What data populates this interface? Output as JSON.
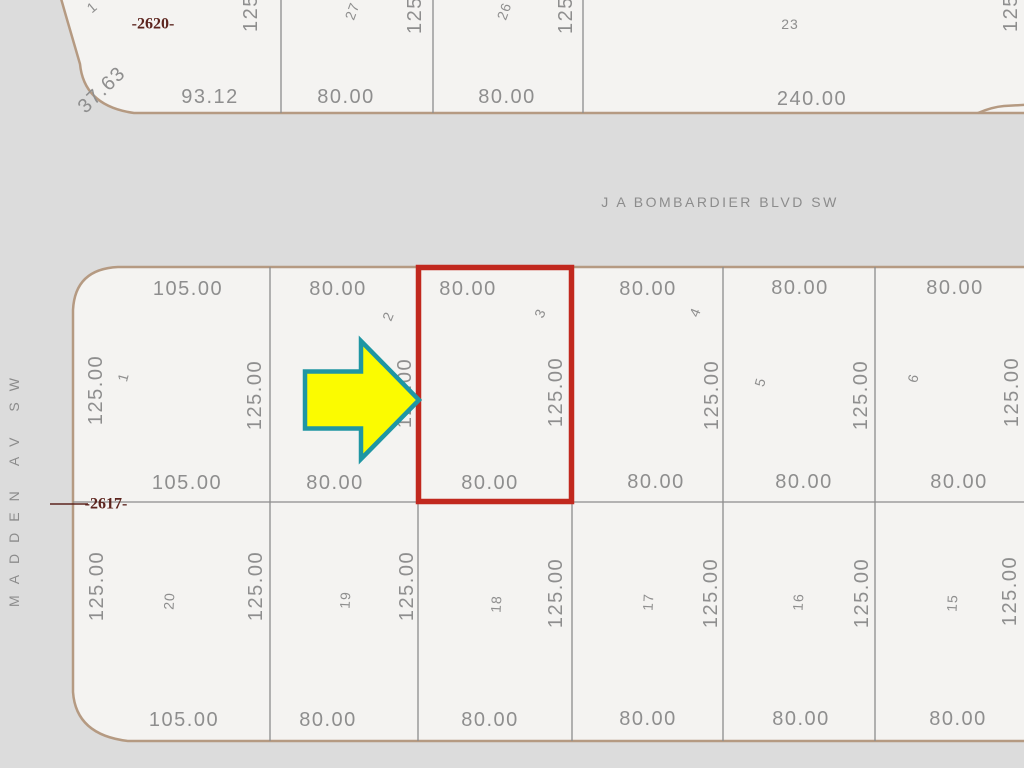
{
  "colors": {
    "street_bg": "#dcdcdc",
    "lot_fill": "#f4f3f1",
    "block_outline": "#b59a82",
    "lot_line": "#8c8c8c",
    "label_text": "#8e8e8e",
    "block_number_text": "#5c241e",
    "highlight_red": "#c1281e",
    "arrow_fill": "#fbfb00",
    "arrow_outline": "#1f96a3"
  },
  "streets": {
    "bombardier": "J A BOMBARDIER BLVD SW",
    "madden": "MADDEN AV SW"
  },
  "upper_block": {
    "number": "-2620-",
    "corner_lot": "1",
    "corner_dim": "37.63",
    "bottom_dims": [
      "93.12",
      "80.00",
      "80.00",
      "240.00"
    ],
    "lot_numbers": [
      "27",
      "26",
      "23"
    ],
    "side_dims_cut": [
      "125",
      "125",
      "125",
      "125"
    ]
  },
  "main_block": {
    "number": "-2617-",
    "north_row": {
      "lot_numbers": [
        "1",
        "2",
        "3",
        "4",
        "5",
        "6"
      ],
      "front_dims": [
        "105.00",
        "80.00",
        "80.00",
        "80.00",
        "80.00",
        "80.00"
      ],
      "rear_dims": [
        "105.00",
        "80.00",
        "80.00",
        "80.00",
        "80.00",
        "80.00"
      ],
      "side_dims": [
        "125.00",
        "125.00",
        "125.00",
        "125.00",
        "125.00",
        "125.00",
        "125.00"
      ]
    },
    "south_row": {
      "lot_numbers": [
        "20",
        "19",
        "18",
        "17",
        "16",
        "15"
      ],
      "side_dims": [
        "125.00",
        "125.00",
        "125.00",
        "125.00",
        "125.00",
        "125.00",
        "125.00"
      ],
      "front_dims": [
        "105.00",
        "80.00",
        "80.00",
        "80.00",
        "80.00",
        "80.00"
      ]
    }
  },
  "annotations": {
    "highlighted_lot": "3"
  }
}
